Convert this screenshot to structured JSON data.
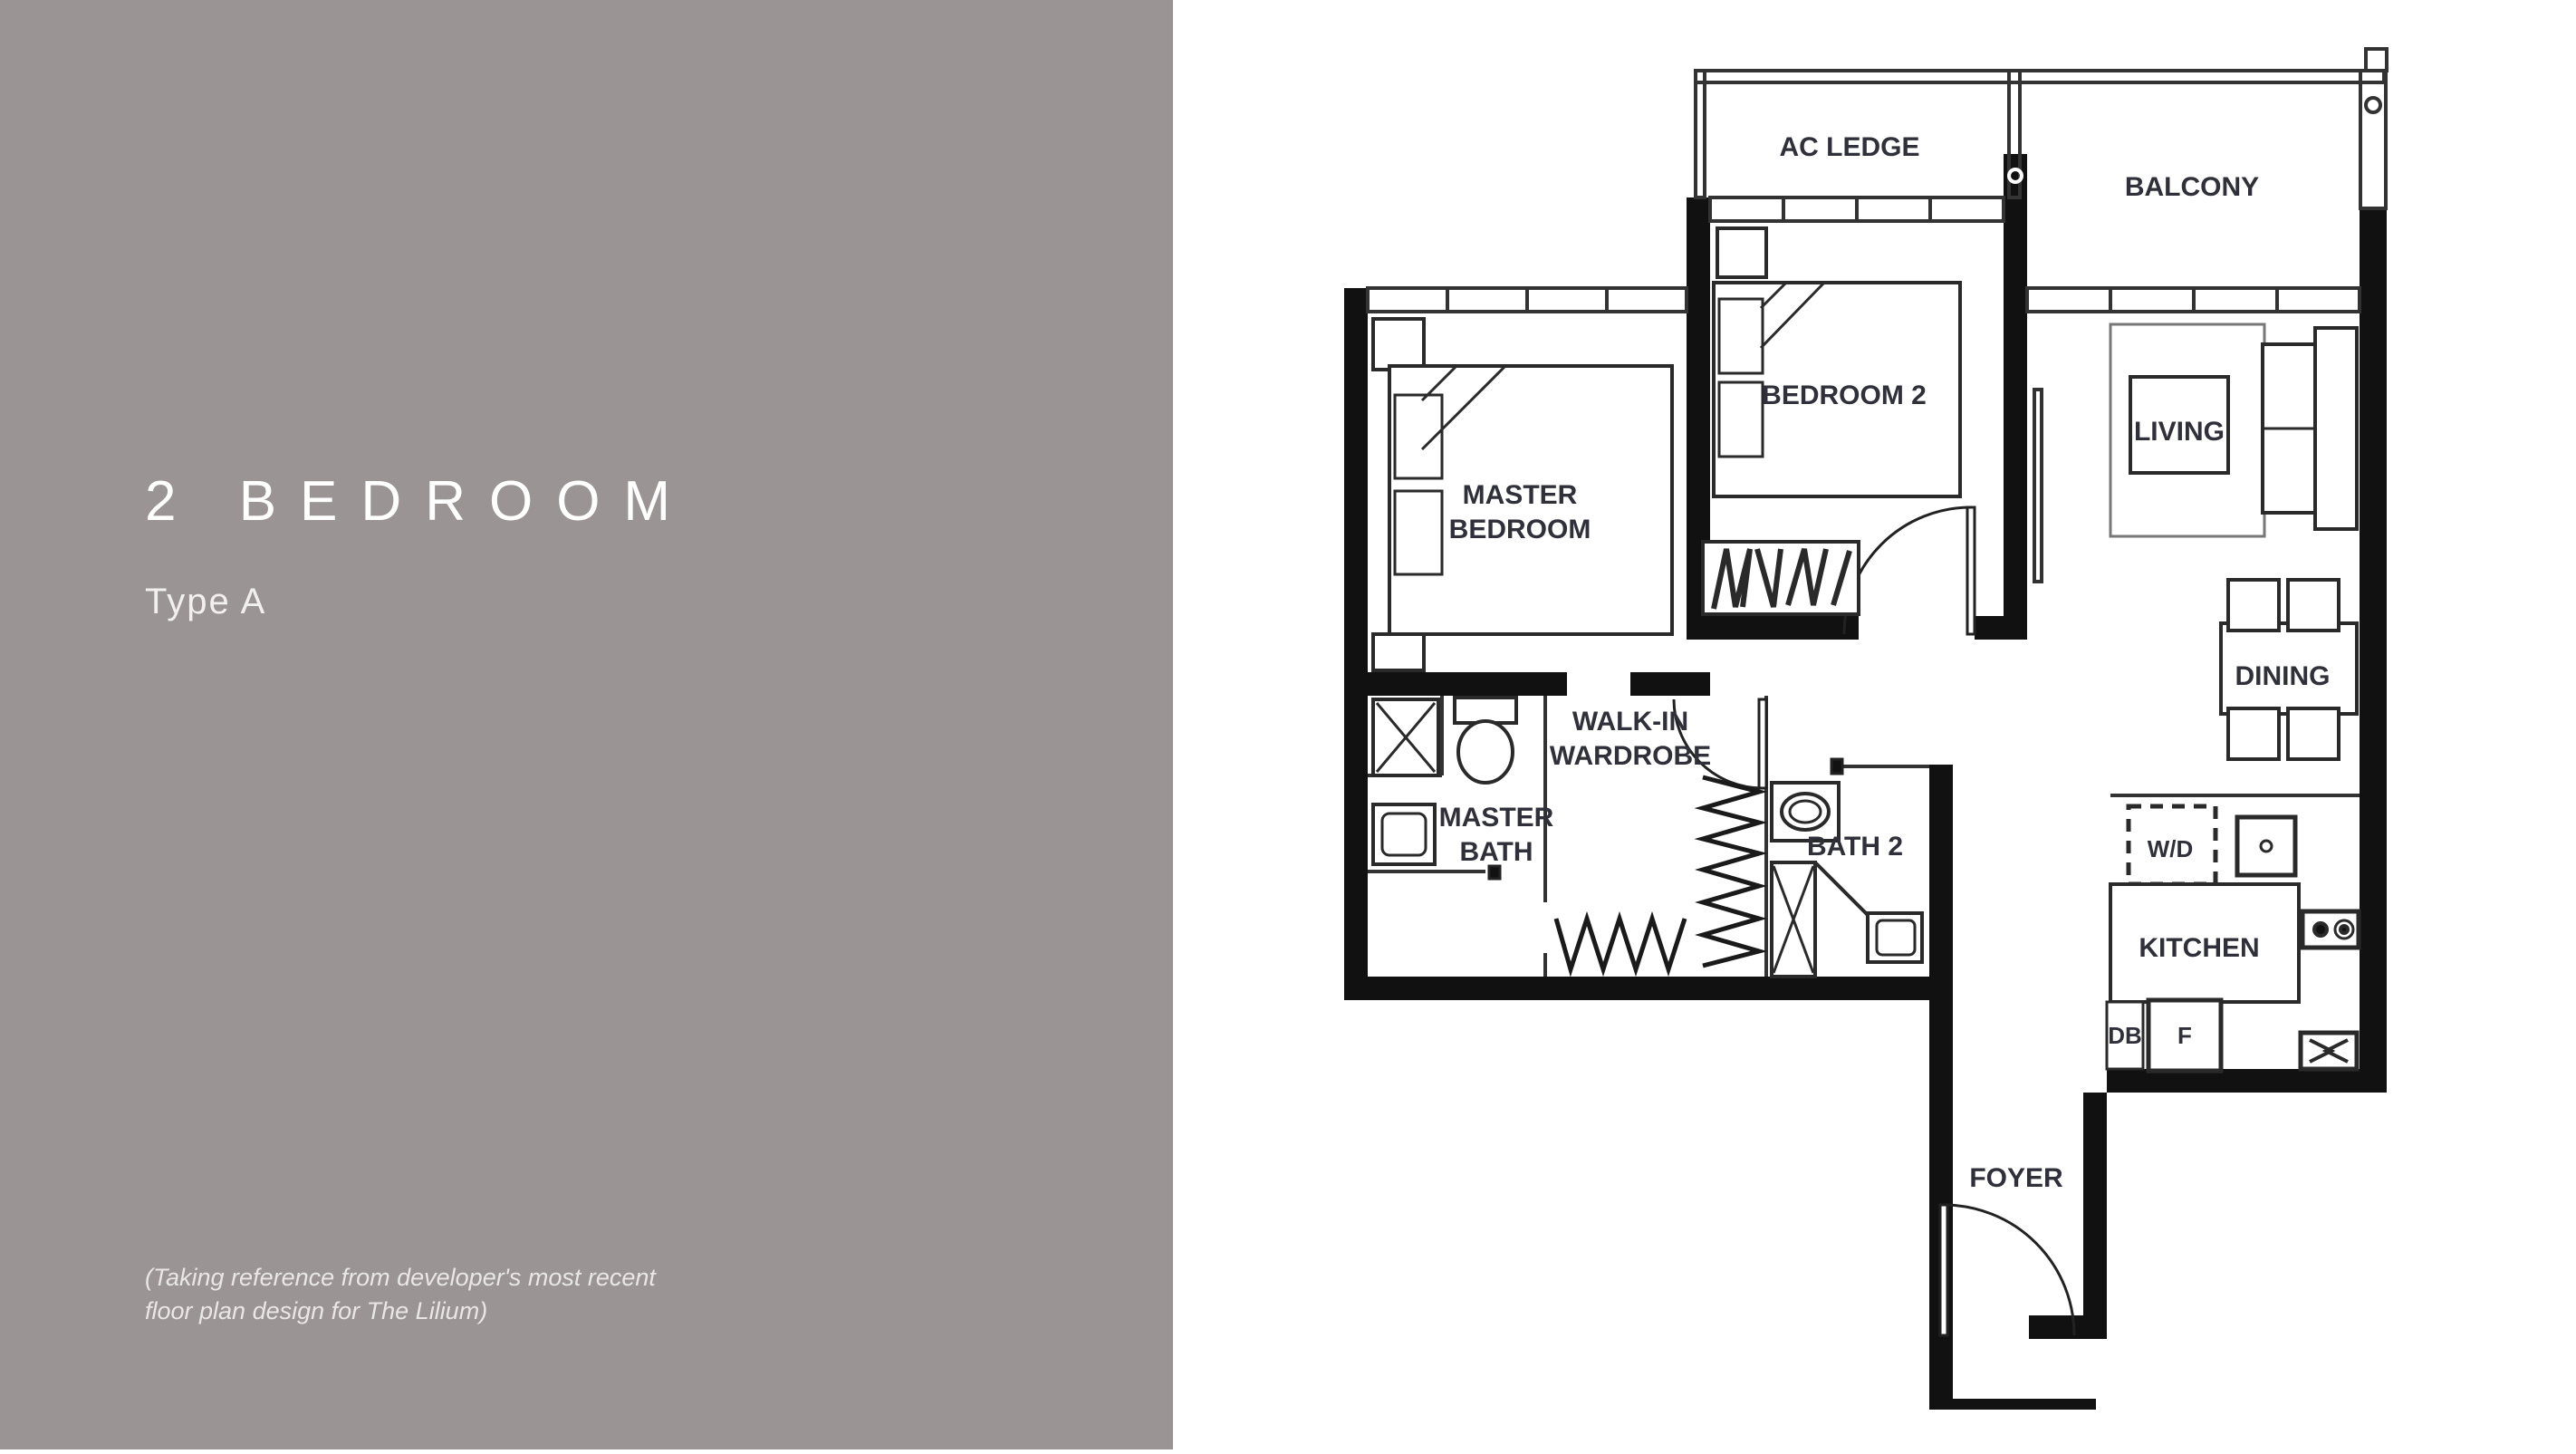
{
  "panel": {
    "title": "2 BEDROOM",
    "subtitle": "Type A",
    "note_line1": "(Taking reference from developer's most recent",
    "note_line2": "floor plan design for The Lilium)"
  },
  "floorplan": {
    "labels": {
      "ac_ledge": "AC LEDGE",
      "balcony": "BALCONY",
      "bedroom2": "BEDROOM 2",
      "master_bedroom_line1": "MASTER",
      "master_bedroom_line2": "BEDROOM",
      "living": "LIVING",
      "dining": "DINING",
      "walkin_line1": "WALK-IN",
      "walkin_line2": "WARDROBE",
      "master_bath_line1": "MASTER",
      "master_bath_line2": "BATH",
      "bath2": "BATH 2",
      "kitchen": "KITCHEN",
      "washer_dryer": "W/D",
      "distribution_board": "DB",
      "fridge": "F",
      "foyer": "FOYER"
    }
  },
  "colors": {
    "panel_bg": "#9a9594",
    "panel_text": "#ffffff",
    "plan_line": "#111111",
    "plan_label": "#30303a"
  }
}
